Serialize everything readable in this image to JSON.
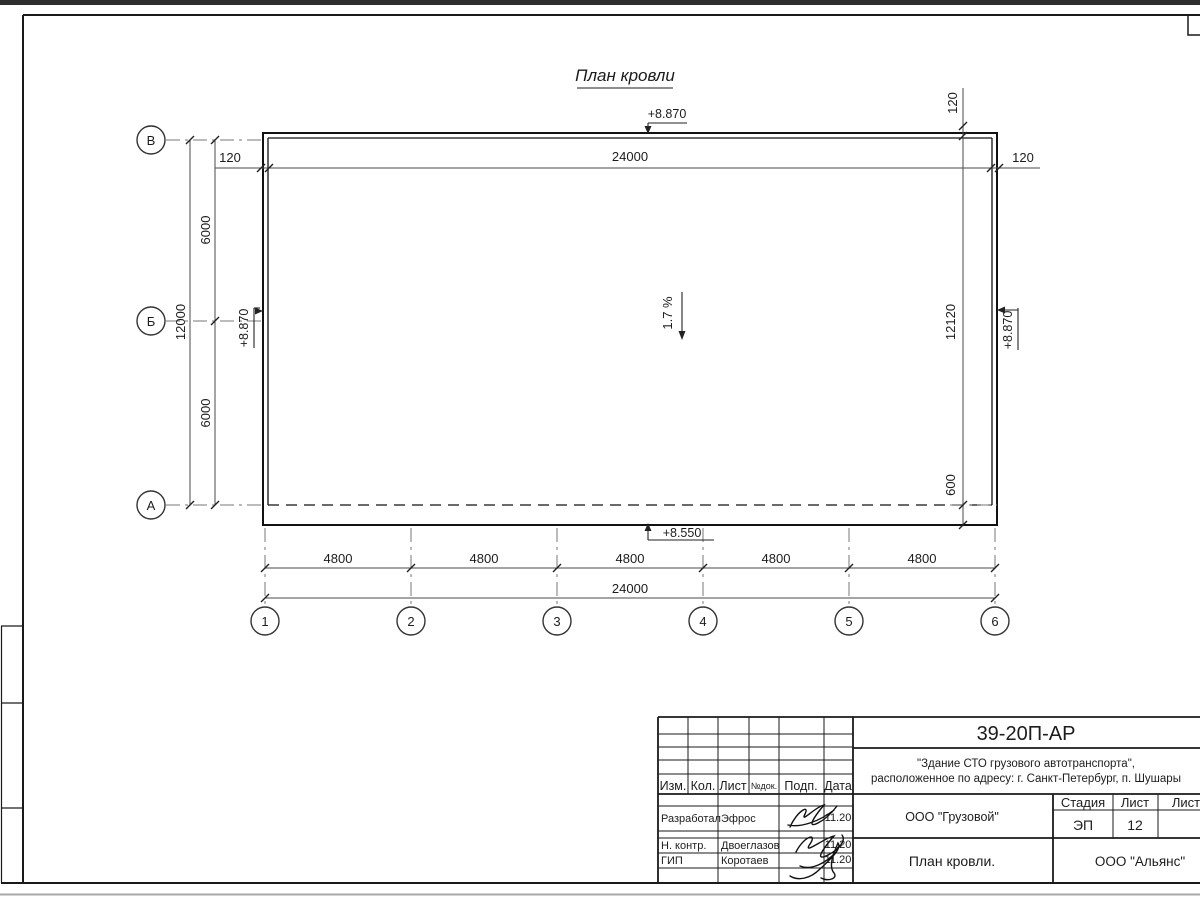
{
  "drawing": {
    "title": "План кровли",
    "axes": {
      "rows": [
        "В",
        "Б",
        "А"
      ],
      "cols": [
        "1",
        "2",
        "3",
        "4",
        "5",
        "6"
      ]
    },
    "dims": {
      "top_overhang_left": "120",
      "top_overall": "24000",
      "top_overhang_right": "120",
      "right_overhang_top": "120",
      "left_bay_upper": "6000",
      "left_bay_lower": "6000",
      "left_overall": "12000",
      "right_overall": "12120",
      "right_overhang_bottom": "600",
      "bottom_bays": [
        "4800",
        "4800",
        "4800",
        "4800",
        "4800"
      ],
      "bottom_overall": "24000"
    },
    "marks": {
      "elev_top": "+8.870",
      "elev_left": "+8.870",
      "elev_right": "+8.870",
      "elev_bottom": "+8.550",
      "slope": "1.7 %"
    }
  },
  "title_block": {
    "doc_number": "39-20П-АР",
    "project_line1": "\"Здание СТО грузового автотранспорта\",",
    "project_line2": "расположенное по адресу: г. Санкт-Петербург, п. Шушары",
    "header": {
      "izm": "Изм.",
      "kol": "Кол.",
      "list": "Лист",
      "ndoc": "№док.",
      "podp": "Подп.",
      "data": "Дата"
    },
    "rows": [
      {
        "role": "Разработал",
        "name": "Эфрос",
        "date": "11.20"
      },
      {
        "role": "Н. контр.",
        "name": "Двоеглазов",
        "date": "11.20"
      },
      {
        "role": "ГИП",
        "name": "Коротаев",
        "date": "11.20"
      }
    ],
    "client": "ООО \"Грузовой\"",
    "stage_label": "Стадия",
    "stage_value": "ЭП",
    "sheet_label": "Лист",
    "sheet_value": "12",
    "sheets_label": "Листов",
    "sheet_title": "План кровли.",
    "company": "ООО \"Альянс\""
  }
}
